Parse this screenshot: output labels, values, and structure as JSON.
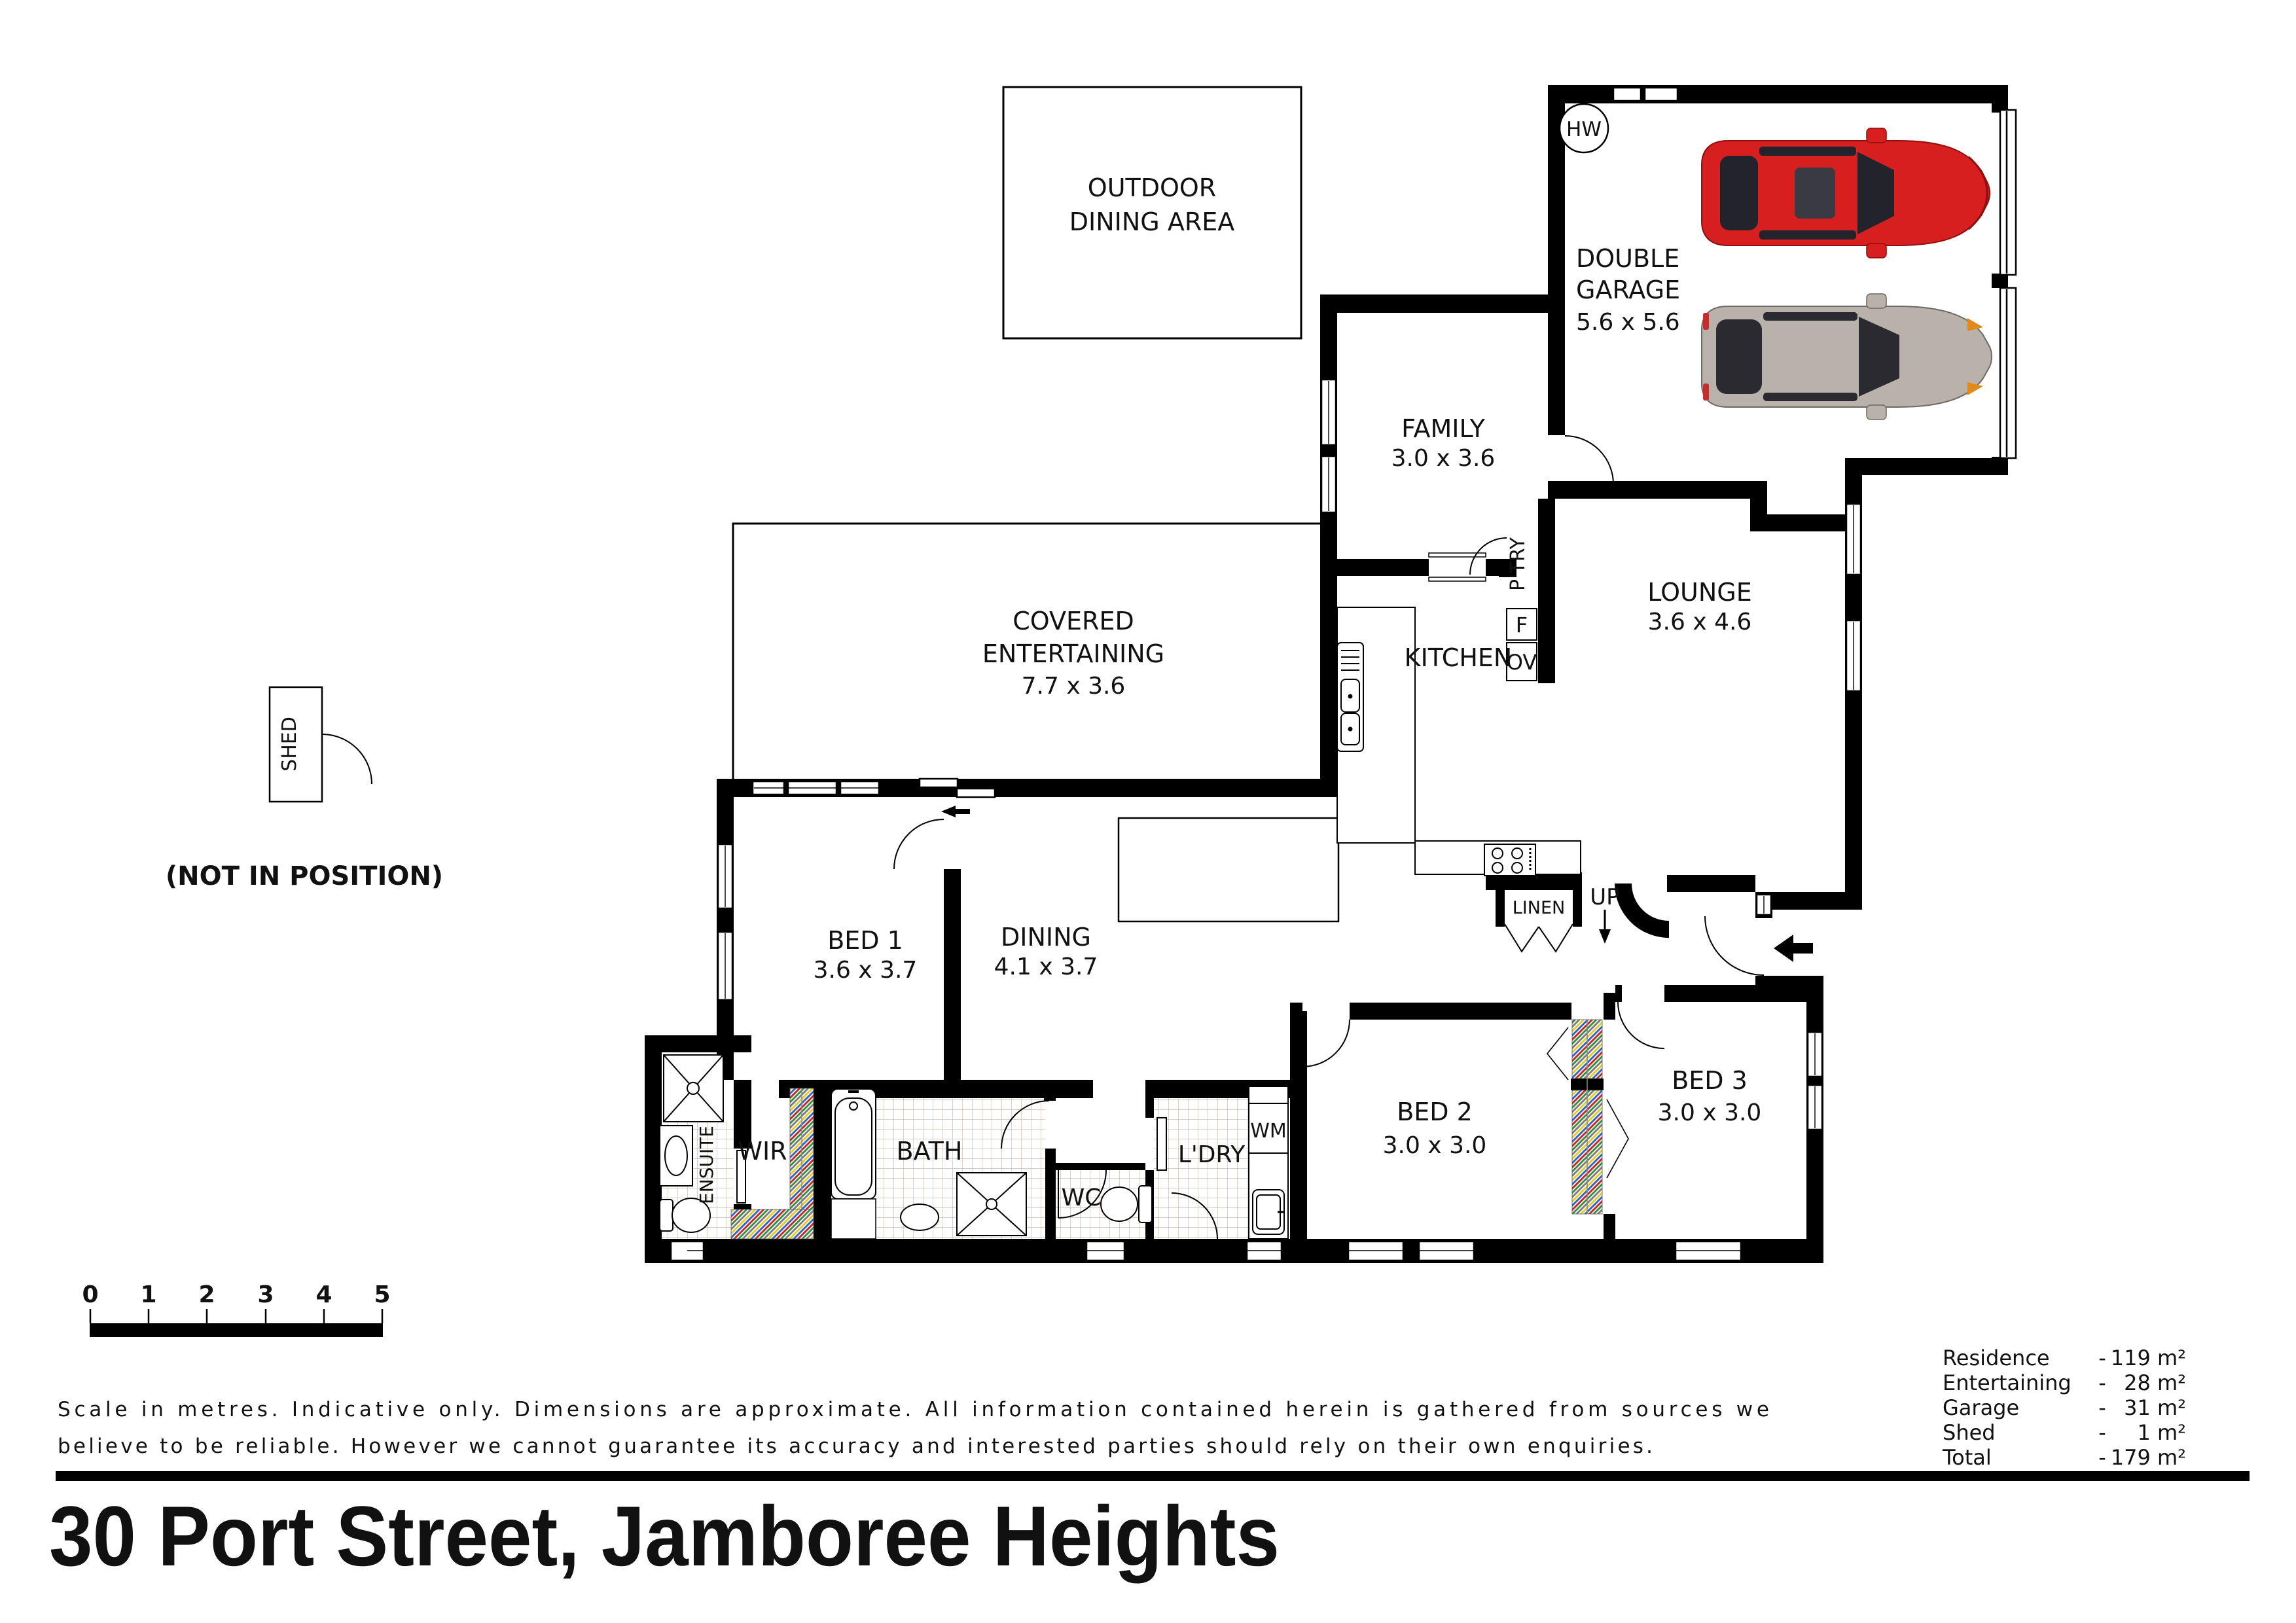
{
  "title": "30 Port Street, Jamboree Heights",
  "plan": {
    "outdoor_dining": {
      "line1": "OUTDOOR",
      "line2": "DINING AREA"
    },
    "garage": {
      "line1": "DOUBLE",
      "line2": "GARAGE",
      "dims": "5.6 x 5.6"
    },
    "hw": {
      "name": "HW"
    },
    "family": {
      "name": "FAMILY",
      "dims": "3.0 x 3.6"
    },
    "kitchen": {
      "name": "KITCHEN"
    },
    "pantry": {
      "name": "P'TRY"
    },
    "fridge": {
      "name": "F"
    },
    "oven": {
      "name": "OV"
    },
    "lounge": {
      "name": "LOUNGE",
      "dims": "3.6 x 4.6"
    },
    "linen": {
      "name": "LINEN"
    },
    "up": {
      "name": "UP"
    },
    "covered": {
      "line1": "COVERED",
      "line2": "ENTERTAINING",
      "dims": "7.7 x 3.6"
    },
    "bed1": {
      "name": "BED 1",
      "dims": "3.6 x 3.7"
    },
    "dining": {
      "name": "DINING",
      "dims": "4.1 x 3.7"
    },
    "ensuite": {
      "name": "ENSUITE"
    },
    "wir": {
      "name": "WIR"
    },
    "bath": {
      "name": "BATH"
    },
    "wc": {
      "name": "WC"
    },
    "ldry": {
      "name": "L'DRY"
    },
    "wm": {
      "name": "WM"
    },
    "bed2": {
      "name": "BED 2",
      "dims": "3.0 x 3.0"
    },
    "bed3": {
      "name": "BED 3",
      "dims": "3.0 x 3.0"
    },
    "shed": {
      "name": "SHED"
    },
    "not_in_position": "(NOT IN POSITION)"
  },
  "scale_bar": {
    "labels": [
      "0",
      "1",
      "2",
      "3",
      "4",
      "5"
    ]
  },
  "disclaimer": {
    "line1": "Scale in metres. Indicative only. Dimensions are approximate.  All information contained herein is gathered from sources we",
    "line2": "believe to be reliable. However we cannot guarantee its accuracy and interested parties should rely on their own enquiries."
  },
  "areas": {
    "rows": [
      {
        "label": "Residence",
        "sep": "-",
        "value": "119 m²"
      },
      {
        "label": "Entertaining",
        "sep": "-",
        "value": "28 m²"
      },
      {
        "label": "Garage",
        "sep": "-",
        "value": "31 m²"
      },
      {
        "label": "Shed",
        "sep": "-",
        "value": "1 m²"
      },
      {
        "label": "Total",
        "sep": "-",
        "value": "179 m²"
      }
    ]
  },
  "colors": {
    "wall": "#000000",
    "tile_line": "#c9bfae",
    "car_red": "#d81f1f",
    "car_silver": "#b9b2ab",
    "glass": "#23232b",
    "robe_red": "#c32222",
    "robe_blue": "#2f5fc4",
    "robe_yellow": "#e0ca1f",
    "robe_green": "#2e8b35",
    "robe_grey": "#777777"
  }
}
